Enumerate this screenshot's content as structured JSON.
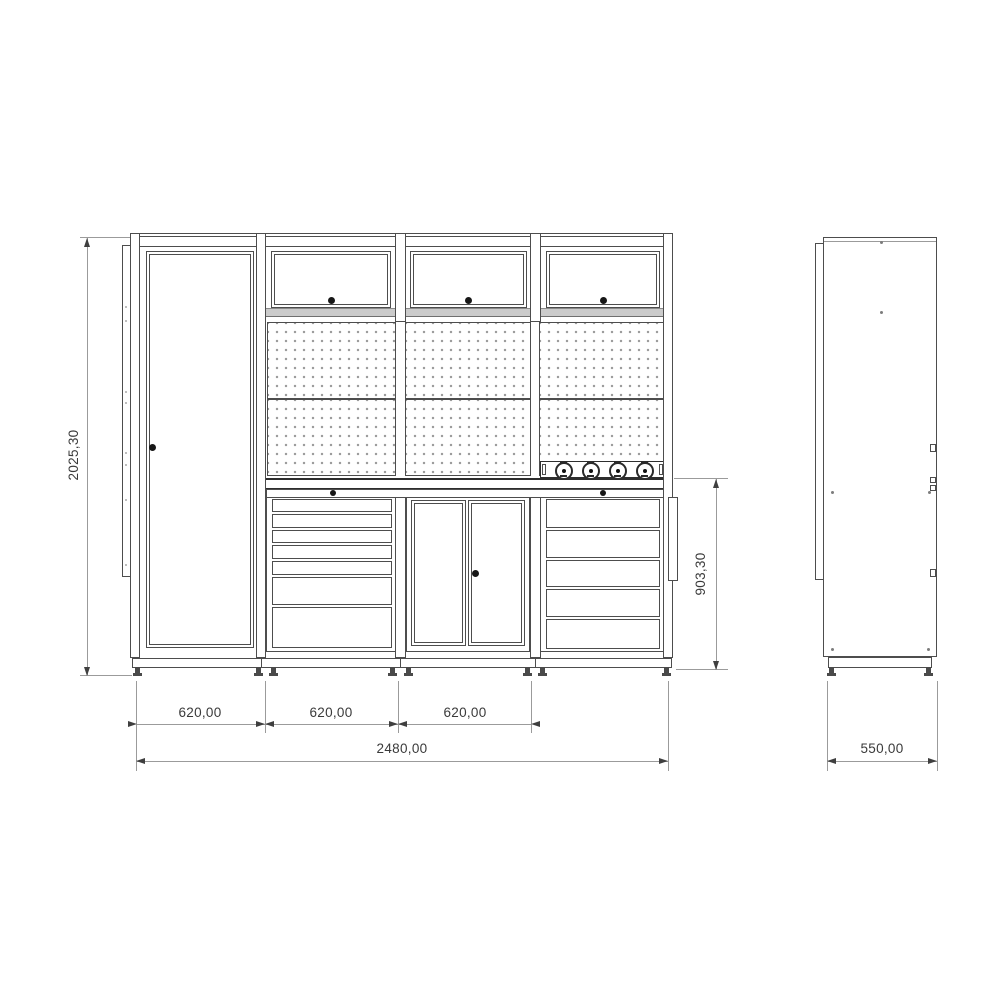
{
  "drawing": {
    "dimensions": {
      "total_height": "2025,30",
      "bench_height": "903,30",
      "module_width_1": "620,00",
      "module_width_2": "620,00",
      "module_width_3": "620,00",
      "total_width": "2480,00",
      "depth": "550,00"
    },
    "icons": {
      "door_handle": "filled-dot",
      "lock": "filled-dot",
      "power_socket": "schuko-circle-with-pin",
      "peg_hole": "small-gray-dot",
      "leveling_foot": "filled-foot-glyph"
    },
    "colors": {
      "line": "#4d4d4d",
      "dim_line": "#9b9b9b",
      "dim_text": "#3a3a3a",
      "peg_dot": "#9c9c9c",
      "rail_band": "#cbcbcb",
      "background": "#ffffff"
    }
  }
}
